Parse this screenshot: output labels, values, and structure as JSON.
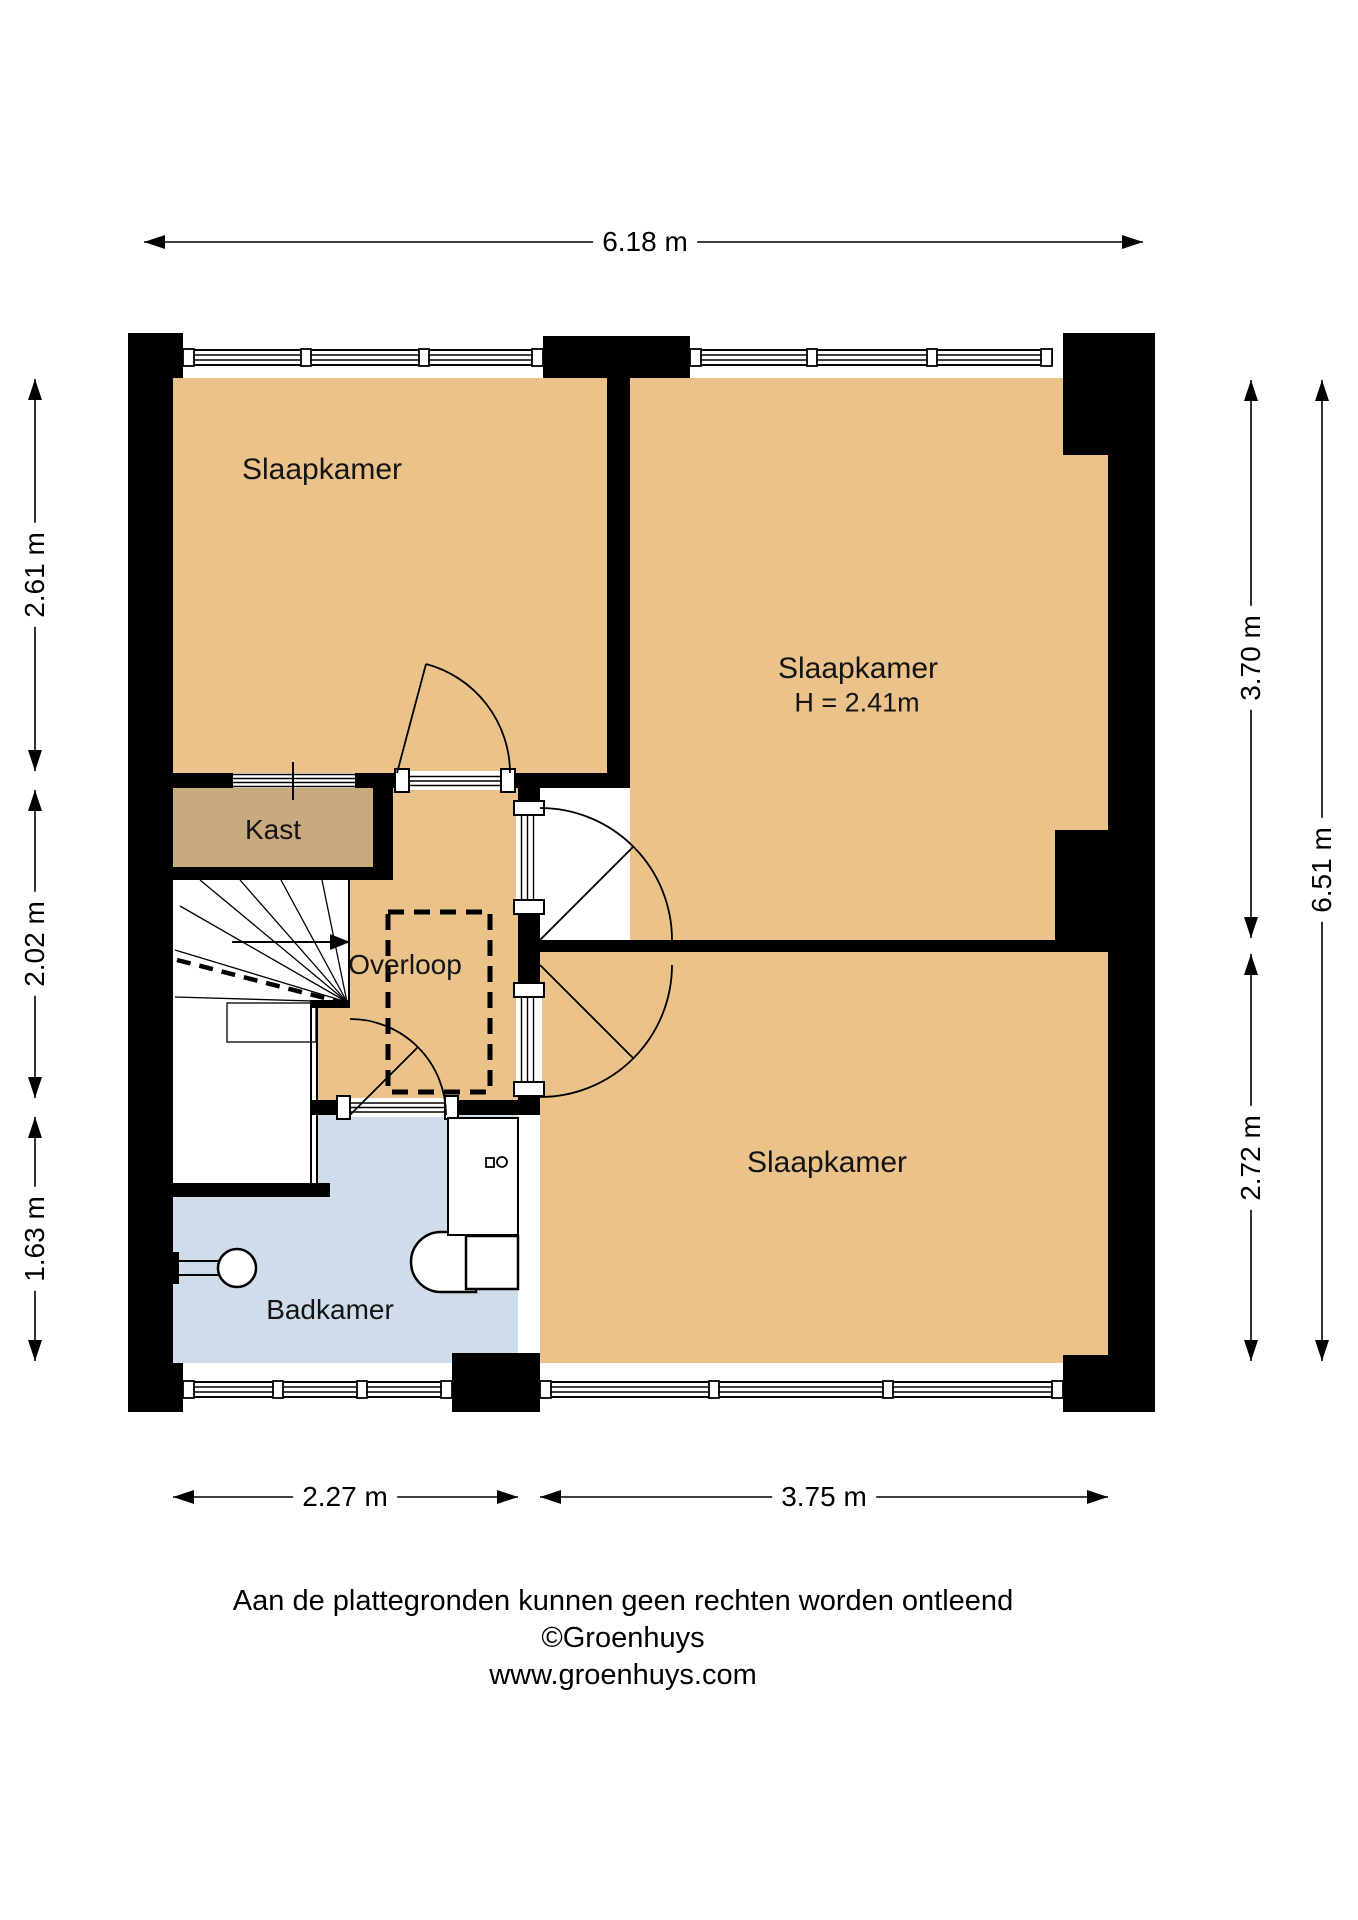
{
  "rooms": {
    "slaapkamer_top_left": {
      "label": "Slaapkamer"
    },
    "slaapkamer_top_right": {
      "label": "Slaapkamer",
      "ceiling_height": "H = 2.41m"
    },
    "slaapkamer_bottom": {
      "label": "Slaapkamer"
    },
    "kast": {
      "label": "Kast"
    },
    "overloop": {
      "label": "Overloop"
    },
    "badkamer": {
      "label": "Badkamer"
    }
  },
  "dimensions": {
    "top_width": "6.18 m",
    "left": [
      "2.61 m",
      "2.02 m",
      "1.63 m"
    ],
    "right_inner": [
      "3.70 m",
      "2.72 m"
    ],
    "right_outer": "6.51 m",
    "bottom": [
      "2.27 m",
      "3.75 m"
    ]
  },
  "footer": {
    "disclaimer": "Aan de plattegronden kunnen geen rechten worden ontleend",
    "copyright": "©Groenhuys",
    "website": "www.groenhuys.com"
  },
  "colors": {
    "room_fill": "#EBC28A",
    "closet_fill": "#C9A97E",
    "bathroom_fill": "#CFDDEA",
    "wall": "#000000",
    "background": "#FFFFFF"
  }
}
